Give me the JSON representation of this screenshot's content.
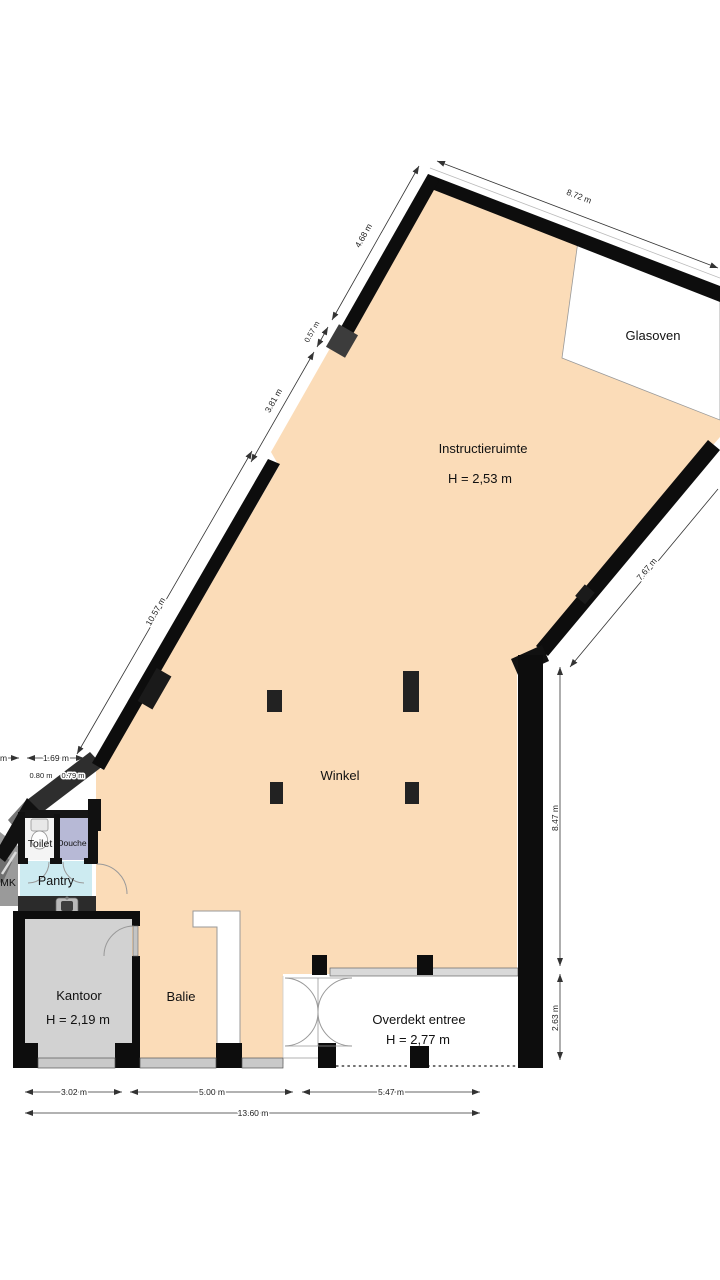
{
  "plan": {
    "rooms": {
      "glasoven": {
        "label": "Glasoven"
      },
      "instructieruimte": {
        "label": "Instructieruimte",
        "height": "H = 2,53 m"
      },
      "winkel": {
        "label": "Winkel"
      },
      "balie": {
        "label": "Balie"
      },
      "kantoor": {
        "label": "Kantoor",
        "height": "H = 2,19 m"
      },
      "overdekt_entree": {
        "label": "Overdekt entree",
        "height": "H = 2,77 m"
      },
      "toilet": {
        "label": "Toilet"
      },
      "douche": {
        "label": "Douche"
      },
      "pantry": {
        "label": "Pantry"
      },
      "mk": {
        "label": "MK"
      }
    },
    "dimensions": {
      "top_wall": "8.72 m",
      "upper_left_wall_1": "4.68 m",
      "upper_left_wall_2": "0.57 m",
      "upper_left_wall_3": "3.81 m",
      "left_wall": "10.57 m",
      "right_diagonal_wall": "7.67 m",
      "right_side_upper": "8.47 m",
      "right_side_lower": "2.63 m",
      "left_block_total": "1.69 m",
      "left_block_a": "0.80 m",
      "left_block_b": "0.79 m",
      "left_edge_cut": "m",
      "front_kantoor": "3.02 m",
      "front_winkel": "5.00 m",
      "front_entree": "5.47 m",
      "front_total": "13.60 m"
    },
    "colors": {
      "floor_main": "#fbdcb8",
      "floor_kantoor": "#d2d2d2",
      "floor_douche": "#b7b9d6",
      "floor_pantry": "#cdebf1",
      "floor_glasoven": "#ffffff",
      "wall": "#0d0d0d"
    }
  }
}
